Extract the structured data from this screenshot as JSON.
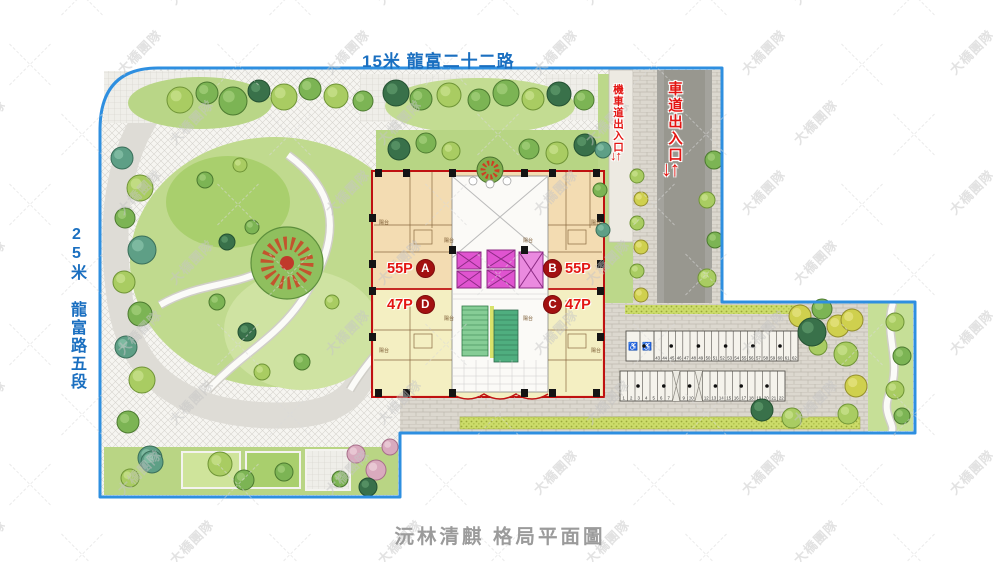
{
  "roads": {
    "top_label": "15米 龍富二十二路",
    "left_label": "25米 龍富路五段"
  },
  "entrances": {
    "motorcycle_label": "機車道出入口",
    "car_label": "車道出入口",
    "arrows": "↓↑"
  },
  "building": {
    "units": {
      "a": {
        "size": "55P",
        "letter": "A"
      },
      "b": {
        "size": "55P",
        "letter": "B"
      },
      "c": {
        "size": "47P",
        "letter": "C"
      },
      "d": {
        "size": "47P",
        "letter": "D"
      }
    },
    "balcony_label": "陽台"
  },
  "parking": {
    "accessible_icon": "♿",
    "rows": [
      {
        "x": 626,
        "y": 331,
        "h": 30,
        "stall_w": 7.2,
        "handicap": 2,
        "handicap_w": 14,
        "crossed": [],
        "stalls": [
          "43",
          "44",
          "45",
          "46",
          "47",
          "48",
          "49",
          "50",
          "51",
          "52",
          "53",
          "54",
          "55",
          "56",
          "57",
          "58",
          "59",
          "60",
          "61",
          "62"
        ]
      },
      {
        "x": 620,
        "y": 371,
        "h": 30,
        "stall_w": 7.5,
        "handicap": 0,
        "handicap_w": 0,
        "crossed": [
          7,
          10
        ],
        "stalls": [
          "1",
          "2",
          "3",
          "4",
          "5",
          "6",
          "7",
          "8",
          "9",
          "10",
          "11",
          "12",
          "13",
          "14",
          "15",
          "16",
          "17",
          "18",
          "19",
          "20",
          "21",
          "22"
        ]
      }
    ]
  },
  "watermark": {
    "text": "大橋團隊"
  },
  "footer": {
    "caption": "沅林清麒 格局平面圖"
  },
  "colors": {
    "boundary": "#2e8fe0",
    "road_text": "#1a6fc0",
    "entrance_text": "#e31512",
    "unit_text": "#e31512",
    "unit_badge": "#a31111",
    "building_outline": "#bf1111",
    "caption": "#9b9b9b",
    "watermark": "#c6c6c6"
  },
  "scene": {
    "palette": {
      "g1": [
        "#7cb454",
        "#4c7a30",
        "#a3cf7a"
      ],
      "g2": [
        "#a9cc62",
        "#6f9436",
        "#c9e18d"
      ],
      "g3": [
        "#39714a",
        "#245132",
        "#5d9a6b"
      ],
      "g4": [
        "#5e9f86",
        "#3a6f5a",
        "#88c2a8"
      ],
      "y1": [
        "#cfd04e",
        "#948f2c",
        "#e6e382"
      ],
      "p1": [
        "#d9aabe",
        "#a76f8a",
        "#ecd0da"
      ]
    },
    "trees": [
      [
        180,
        100,
        13,
        "g2"
      ],
      [
        207,
        93,
        11,
        "g1"
      ],
      [
        233,
        101,
        14,
        "g1"
      ],
      [
        259,
        91,
        11,
        "g3"
      ],
      [
        284,
        97,
        13,
        "g2"
      ],
      [
        310,
        89,
        11,
        "g1"
      ],
      [
        336,
        96,
        12,
        "g2"
      ],
      [
        363,
        101,
        10,
        "g1"
      ],
      [
        396,
        93,
        13,
        "g3"
      ],
      [
        421,
        99,
        11,
        "g1"
      ],
      [
        449,
        95,
        12,
        "g2"
      ],
      [
        479,
        100,
        11,
        "g1"
      ],
      [
        506,
        93,
        13,
        "g1"
      ],
      [
        533,
        99,
        11,
        "g2"
      ],
      [
        559,
        94,
        12,
        "g3"
      ],
      [
        584,
        100,
        10,
        "g1"
      ],
      [
        122,
        158,
        11,
        "g4"
      ],
      [
        140,
        188,
        13,
        "g2"
      ],
      [
        125,
        218,
        10,
        "g1"
      ],
      [
        142,
        250,
        14,
        "g4"
      ],
      [
        124,
        282,
        11,
        "g2"
      ],
      [
        140,
        314,
        12,
        "g1"
      ],
      [
        126,
        347,
        11,
        "g4"
      ],
      [
        142,
        380,
        13,
        "g2"
      ],
      [
        128,
        422,
        11,
        "g1"
      ],
      [
        150,
        458,
        12,
        "g4"
      ],
      [
        130,
        478,
        9,
        "g2"
      ],
      [
        227,
        242,
        8,
        "g3"
      ],
      [
        252,
        227,
        7,
        "g1"
      ],
      [
        217,
        302,
        8,
        "g1"
      ],
      [
        247,
        332,
        9,
        "g3"
      ],
      [
        302,
        362,
        8,
        "g1"
      ],
      [
        332,
        302,
        7,
        "g2"
      ],
      [
        262,
        372,
        8,
        "g2"
      ],
      [
        205,
        180,
        8,
        "g1"
      ],
      [
        240,
        165,
        7,
        "g2"
      ],
      [
        399,
        149,
        11,
        "g3"
      ],
      [
        426,
        143,
        10,
        "g1"
      ],
      [
        451,
        151,
        9,
        "g2"
      ],
      [
        529,
        149,
        10,
        "g1"
      ],
      [
        557,
        153,
        11,
        "g2"
      ],
      [
        585,
        145,
        11,
        "g3"
      ],
      [
        637,
        176,
        7,
        "g2"
      ],
      [
        641,
        199,
        7,
        "y1"
      ],
      [
        637,
        223,
        7,
        "g2"
      ],
      [
        641,
        247,
        7,
        "y1"
      ],
      [
        637,
        271,
        7,
        "g2"
      ],
      [
        641,
        295,
        7,
        "y1"
      ],
      [
        714,
        160,
        9,
        "g1"
      ],
      [
        707,
        200,
        8,
        "g2"
      ],
      [
        715,
        240,
        8,
        "g1"
      ],
      [
        707,
        278,
        9,
        "g2"
      ],
      [
        603,
        150,
        8,
        "g4"
      ],
      [
        600,
        190,
        7,
        "g1"
      ],
      [
        603,
        230,
        7,
        "g4"
      ],
      [
        800,
        316,
        11,
        "y1"
      ],
      [
        822,
        309,
        10,
        "g1"
      ],
      [
        838,
        326,
        11,
        "y1"
      ],
      [
        818,
        346,
        9,
        "g2"
      ],
      [
        812,
        332,
        14,
        "g3"
      ],
      [
        852,
        320,
        11,
        "y1"
      ],
      [
        846,
        354,
        12,
        "g2"
      ],
      [
        856,
        386,
        11,
        "y1"
      ],
      [
        848,
        414,
        10,
        "g2"
      ],
      [
        895,
        322,
        9,
        "g2"
      ],
      [
        902,
        356,
        9,
        "g1"
      ],
      [
        895,
        390,
        9,
        "g2"
      ],
      [
        902,
        416,
        8,
        "g1"
      ],
      [
        762,
        410,
        11,
        "g3"
      ],
      [
        792,
        418,
        10,
        "g2"
      ],
      [
        220,
        464,
        12,
        "g2"
      ],
      [
        244,
        480,
        10,
        "g1"
      ],
      [
        284,
        472,
        9,
        "g1"
      ],
      [
        356,
        454,
        9,
        "p1"
      ],
      [
        376,
        470,
        10,
        "p1"
      ],
      [
        390,
        447,
        8,
        "p1"
      ],
      [
        368,
        487,
        9,
        "g3"
      ],
      [
        340,
        479,
        8,
        "g1"
      ],
      [
        152,
        462,
        11,
        "g4"
      ]
    ]
  }
}
